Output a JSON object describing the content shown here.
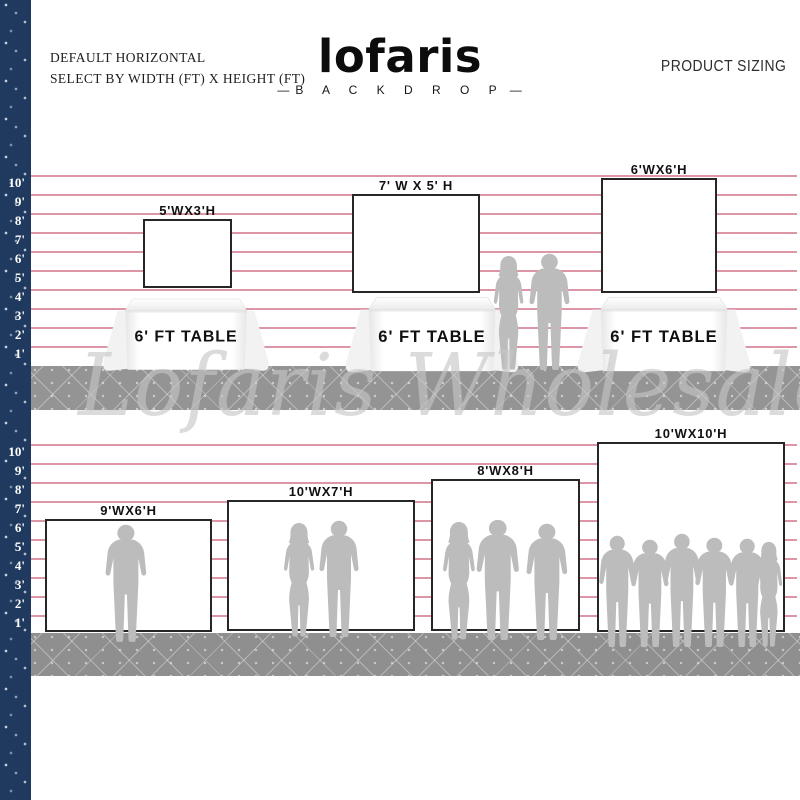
{
  "header": {
    "note_line1": "DEFAULT HORIZONTAL",
    "note_line2": "SELECT BY WIDTH (FT) X HEIGHT (FT)",
    "brand": "lofaris",
    "brand_dash": "—",
    "brand_sub": "B A C K D R O P",
    "product_title": "PRODUCT SIZING"
  },
  "watermark": "Lofaris Wholesale",
  "ruler_labels": [
    "10'",
    "9'",
    "8'",
    "7'",
    "6'",
    "5'",
    "4'",
    "3'",
    "2'",
    "1'"
  ],
  "row1": {
    "backdrops": [
      {
        "label": "5'WX3'H"
      },
      {
        "label": "7' W X 5' H"
      },
      {
        "label": "6'WX6'H"
      }
    ],
    "table_label": "6' FT TABLE"
  },
  "row2": {
    "backdrops": [
      {
        "label": "9'WX6'H"
      },
      {
        "label": "10'WX7'H"
      },
      {
        "label": "8'WX8'H"
      },
      {
        "label": "10'WX10'H"
      }
    ]
  },
  "colors": {
    "guide_line_pink": "#dc96a5",
    "stripe_navy": "#1f3a5e",
    "floor_gray": "#909090",
    "silhouette_gray": "#bcbcbc",
    "watermark_gray": "#c6c6c6",
    "backdrop_border": "#262626"
  }
}
